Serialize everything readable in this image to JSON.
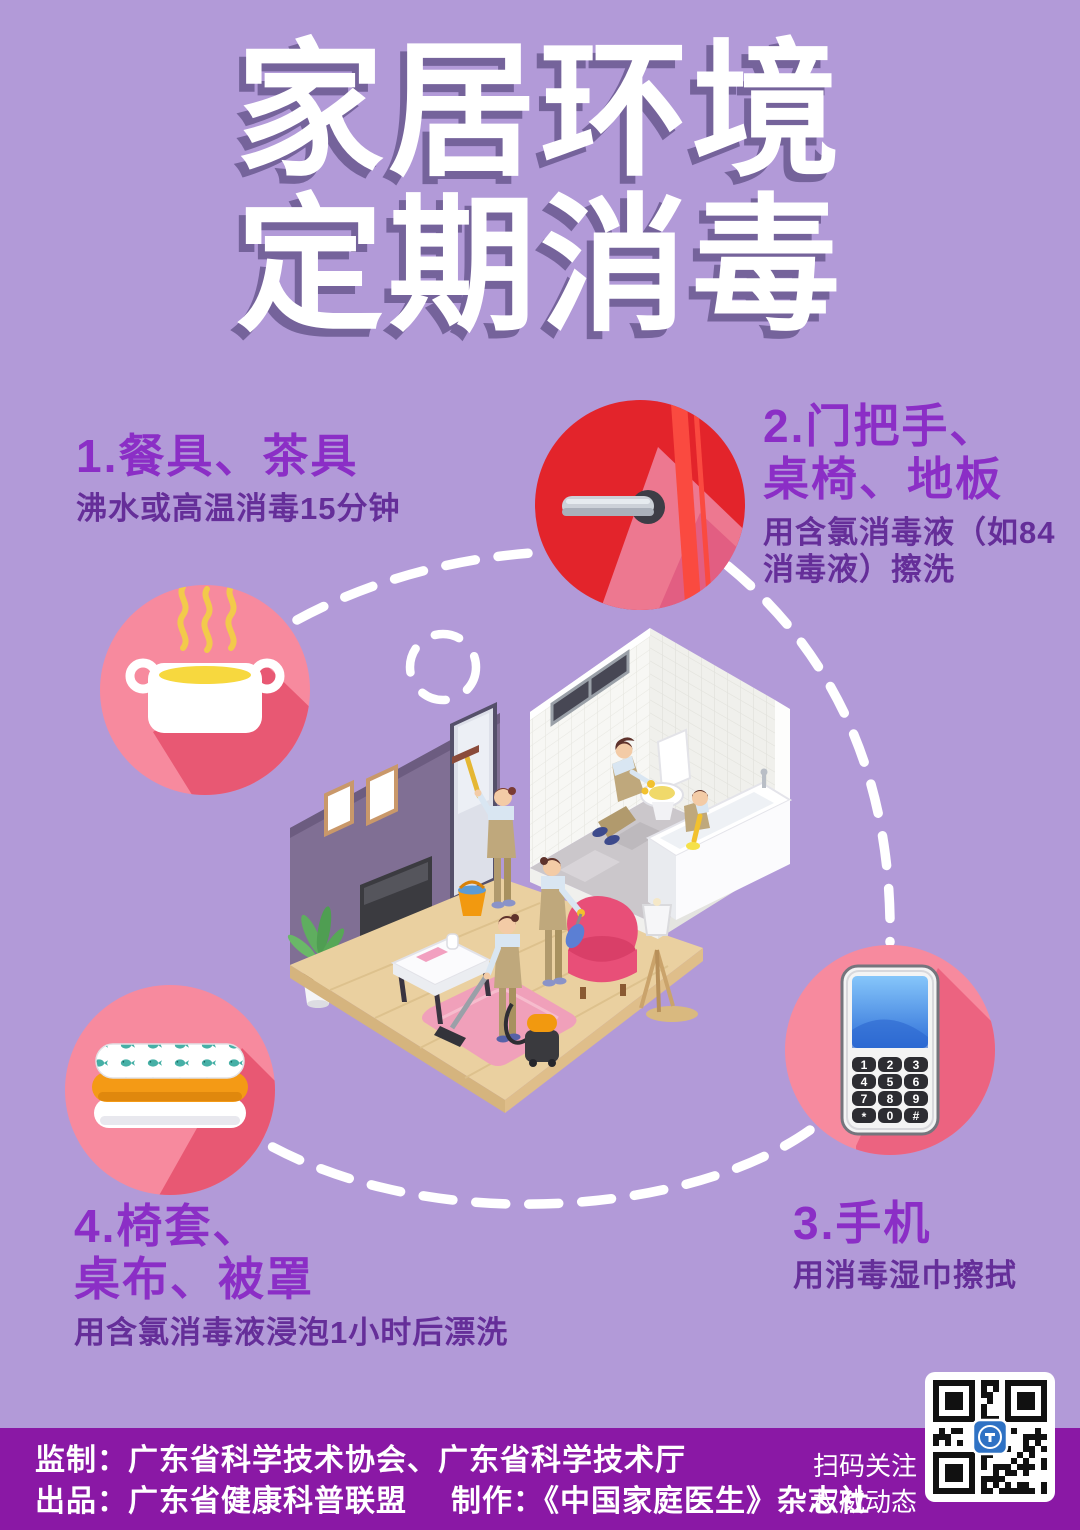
{
  "poster": {
    "title": {
      "line1": "家居环境",
      "line2": "定期消毒"
    },
    "sections": {
      "s1": {
        "heading": "1.餐具、茶具",
        "desc": "沸水或高温消毒15分钟"
      },
      "s2": {
        "heading_line1": "2.门把手、",
        "heading_line2": "桌椅、地板",
        "desc_line1": "用含氯消毒液（如84",
        "desc_line2": "消毒液）擦洗"
      },
      "s3": {
        "heading": "3.手机",
        "desc": "用消毒湿巾擦拭"
      },
      "s4": {
        "heading_line1": "4.椅套、",
        "heading_line2": "桌布、被罩",
        "desc": "用含氯消毒液浸泡1小时后漂洗"
      }
    },
    "icons": {
      "pot": "steaming-pot-icon",
      "door_handle": "door-handle-icon",
      "linens": "folded-linens-icon",
      "phone": {
        "name": "mobile-phone-icon",
        "keys": [
          "1",
          "2",
          "3",
          "4",
          "5",
          "6",
          "7",
          "8",
          "9",
          "*",
          "0",
          "#"
        ]
      }
    },
    "footer": {
      "credit_line1": "监制：广东省科学技术协会、广东省科学技术厅",
      "credit_line2_part1": "出品：广东省健康科普联盟",
      "credit_line2_part2": "制作：《中国家庭医生》杂志社",
      "qr_caption_line1": "扫码关注",
      "qr_caption_line2": "权威动态"
    },
    "colors": {
      "background": "#b29ad8",
      "footer_band": "#8a18a5",
      "heading_purple": "#8b2ec6",
      "desc_purple": "#652e99",
      "title_shadow": "#75639b",
      "circle_pink": "#f78a9e",
      "circle_shadow_rose": "#e85873",
      "door_red": "#e3242b",
      "linen_orange": "#f49a15"
    }
  }
}
